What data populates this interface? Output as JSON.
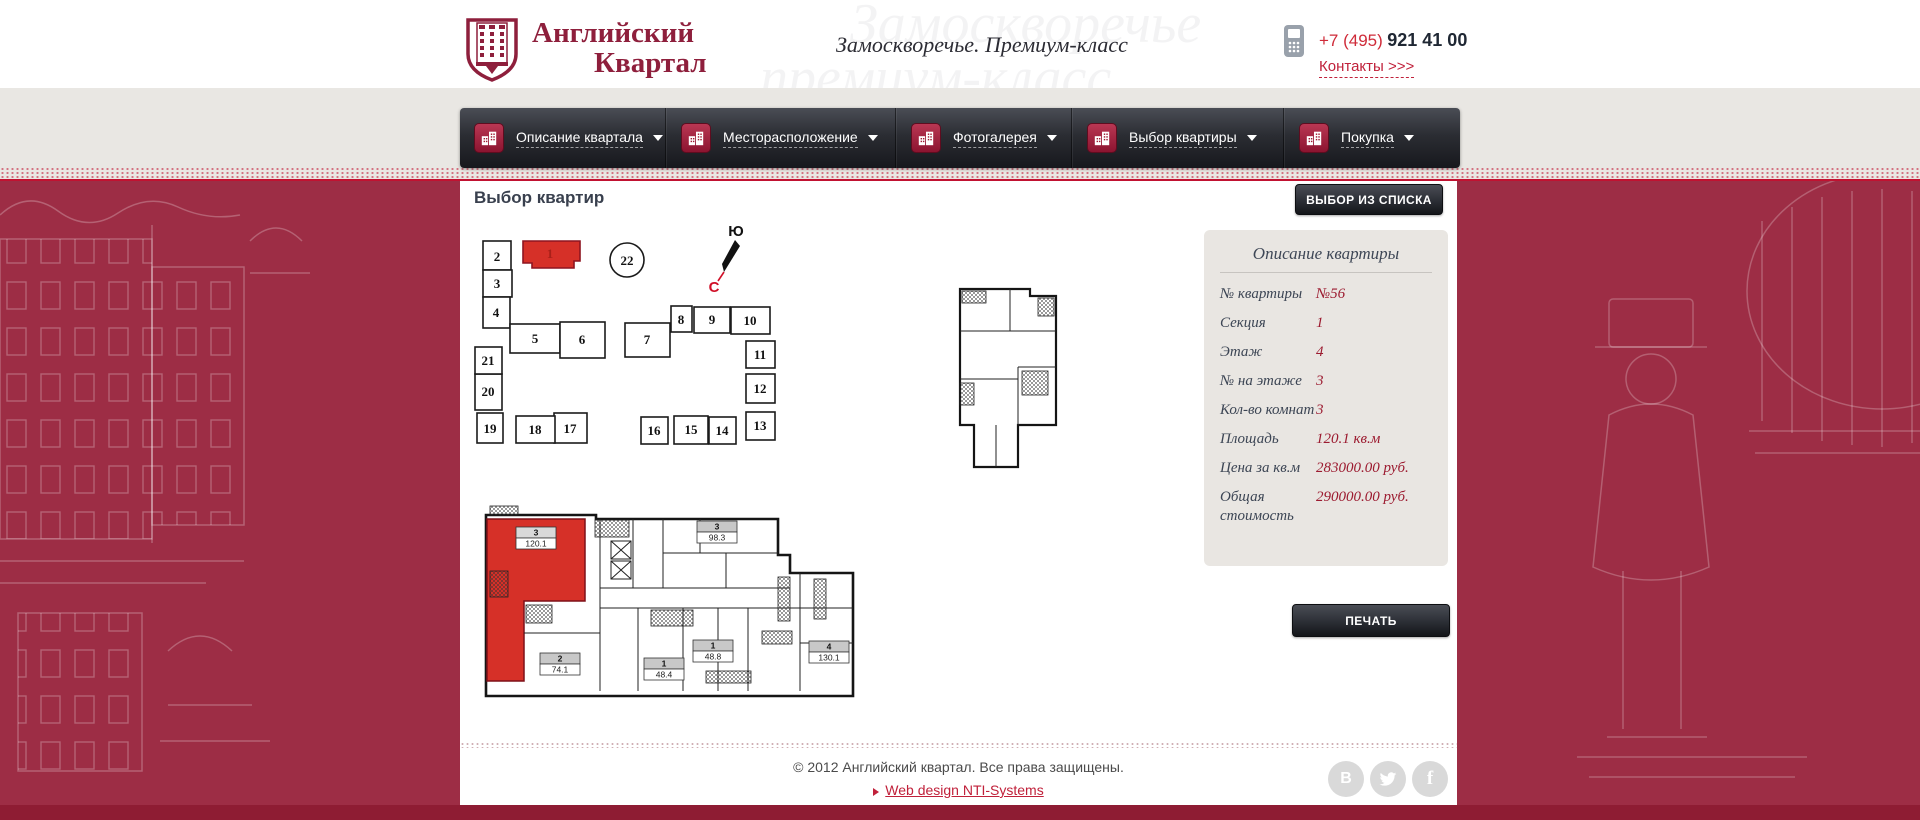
{
  "header": {
    "logo_line1": "Английский",
    "logo_line2": "Квартал",
    "tagline": "Замоскворечье. Премиум-класс",
    "watermark_line1": "Замоскворечье",
    "watermark_line2": "премиум-класс",
    "phone_code": "+7 (495)",
    "phone_number": "921 41 00",
    "contacts_link": "Контакты >>>"
  },
  "nav": {
    "items": [
      {
        "label": "Описание квартала",
        "icon": "district-description-icon"
      },
      {
        "label": "Месторасположение",
        "icon": "location-icon"
      },
      {
        "label": "Фотогалерея",
        "icon": "photo-gallery-icon"
      },
      {
        "label": "Выбор квартиры",
        "icon": "apartment-selection-icon"
      },
      {
        "label": "Покупка",
        "icon": "purchase-icon"
      }
    ]
  },
  "main": {
    "title": "Выбор квартир",
    "list_button": "ВЫБОР ИЗ СПИСКА",
    "print_button": "ПЕЧАТЬ",
    "compass": {
      "south": "Ю",
      "north": "С"
    }
  },
  "site_plan": {
    "units": [
      "1",
      "2",
      "3",
      "4",
      "5",
      "6",
      "7",
      "8",
      "9",
      "10",
      "11",
      "12",
      "13",
      "14",
      "15",
      "16",
      "17",
      "18",
      "19",
      "20",
      "21",
      "22"
    ],
    "highlighted_unit": "1"
  },
  "floor_plan": {
    "apartments": [
      {
        "rooms": "3",
        "area": "120.1",
        "highlighted": true
      },
      {
        "rooms": "3",
        "area": "98.3"
      },
      {
        "rooms": "2",
        "area": "74.1"
      },
      {
        "rooms": "1",
        "area": "48.4"
      },
      {
        "rooms": "1",
        "area": "48.8"
      },
      {
        "rooms": "4",
        "area": "130.1"
      }
    ]
  },
  "details": {
    "title": "Описание квартиры",
    "rows": [
      {
        "label": "№ квартиры",
        "value": "№56"
      },
      {
        "label": "Секция",
        "value": "1"
      },
      {
        "label": "Этаж",
        "value": "4"
      },
      {
        "label": "№ на этаже",
        "value": "3"
      },
      {
        "label": "Кол-во комнат",
        "value": "3"
      },
      {
        "label": "Площадь",
        "value": "120.1 кв.м"
      },
      {
        "label": "Цена за кв.м",
        "value": "283000.00 руб."
      },
      {
        "label": "Общая стоимость",
        "value": "290000.00 руб."
      }
    ]
  },
  "footer": {
    "copyright": "© 2012 Английский квартал. Все права защищены.",
    "design_link": "Web design NTI-Systems",
    "social_vk_glyph": "В",
    "social_fb_glyph": "f"
  },
  "colors": {
    "accent_red": "#c11231",
    "band_red": "#9d2d45",
    "bottom_bar_red": "#8e1c33",
    "highlight_apartment": "#d63028",
    "value_red": "#9c1b30",
    "brand_red": "#8e1f3c",
    "nav_dark": "#2b2d33"
  }
}
